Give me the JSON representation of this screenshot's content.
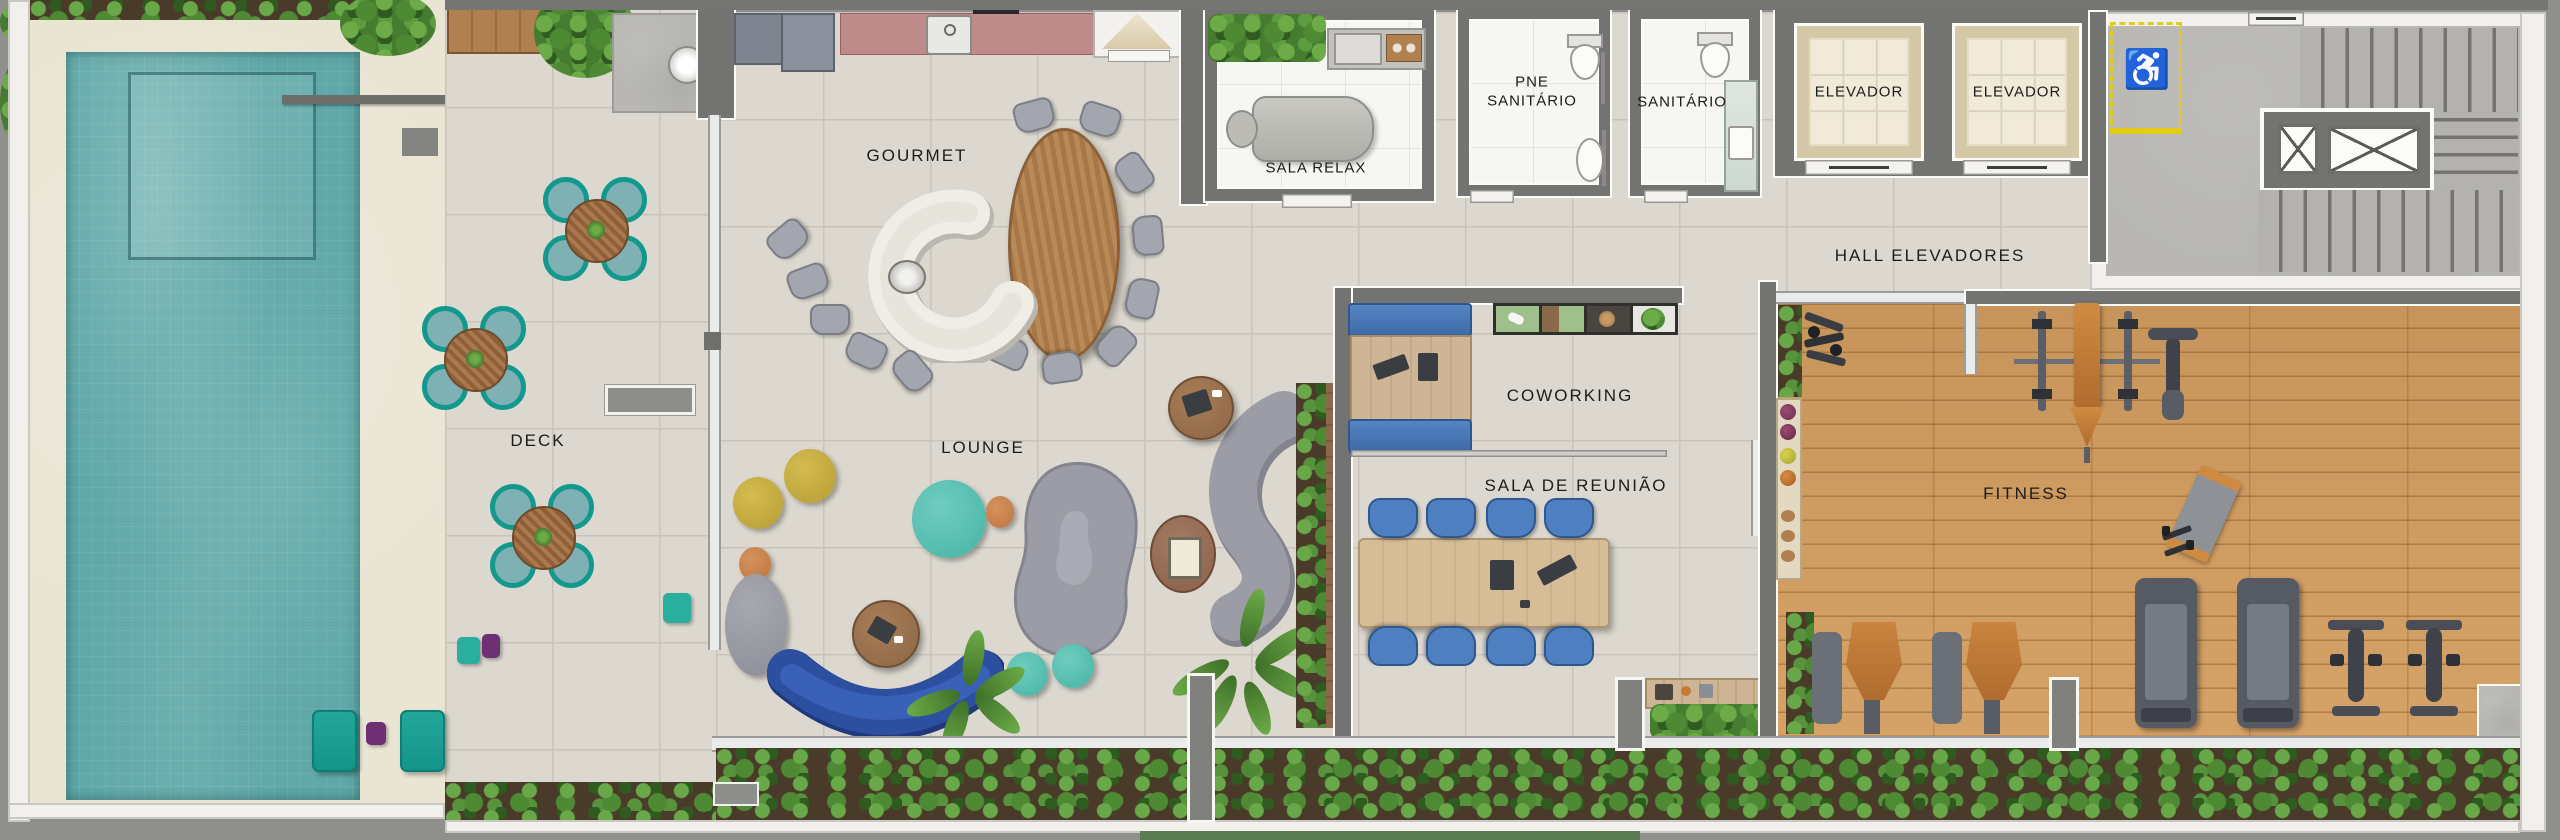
{
  "meta": {
    "kind": "architectural floor plan",
    "floor": "amenities / leisure deck"
  },
  "labels": {
    "deck": "DECK",
    "gourmet": "GOURMET",
    "lounge": "LOUNGE",
    "sala_relax": "SALA RELAX",
    "pne_sanitario": "PNE\nSANITÁRIO",
    "sanitario": "SANITÁRIO",
    "elevador": "ELEVADOR",
    "hall_elevadores": "HALL ELEVADORES",
    "coworking": "COWORKING",
    "sala_reuniao": "SALA DE REUNIÃO",
    "fitness": "FITNESS"
  },
  "icons": {
    "accessible_icon": "♿"
  },
  "colors": {
    "pool_water": "#5fa7a8",
    "deck_tile": "#dcd8cf",
    "pool_surround": "#eae4d3",
    "wall_dark": "#737371",
    "wood_floor": "#cf9a5e",
    "hedge_green": "#4e8a33",
    "teal_furniture": "#14948a",
    "purple_accent": "#6e2f74",
    "blue_sofa": "#2d4fa0",
    "blue_chair": "#4e7fc0",
    "marble_counter": "#efede5",
    "kitchen_counter_pink": "#bf8a8a",
    "elevator_terrazzo": "#d5c8a6",
    "accessible_yellow": "#e3cc15",
    "concrete": "#b8b7b3"
  }
}
